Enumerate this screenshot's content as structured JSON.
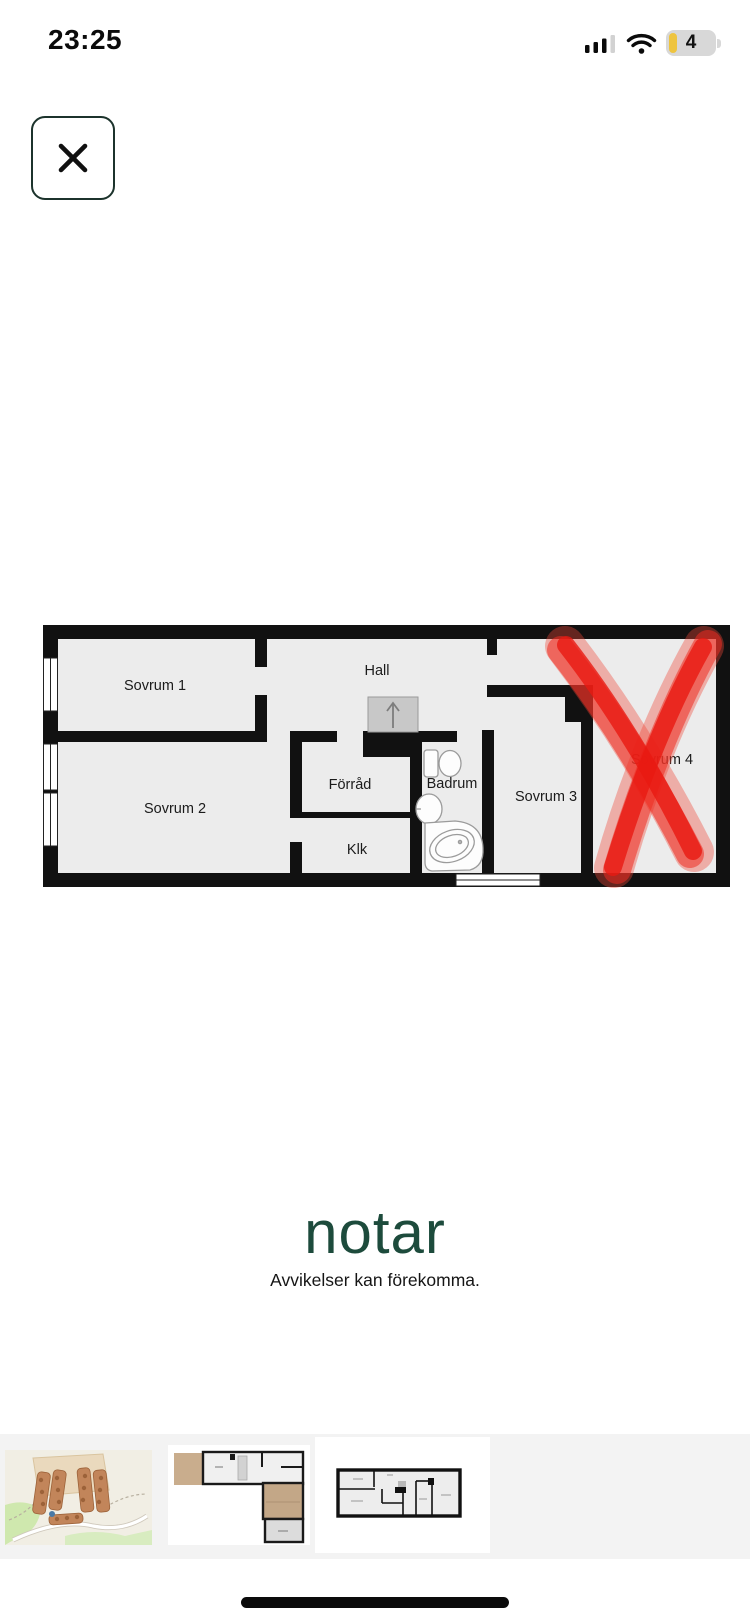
{
  "status_bar": {
    "time": "23:25",
    "battery_level": "4"
  },
  "floorplan": {
    "rooms": [
      {
        "label": "Sovrum 1"
      },
      {
        "label": "Sovrum 2"
      },
      {
        "label": "Hall"
      },
      {
        "label": "Förråd"
      },
      {
        "label": "Klk"
      },
      {
        "label": "Badrum"
      },
      {
        "label": "Sovrum 3"
      },
      {
        "label": "Sovrum 4"
      }
    ]
  },
  "annotation": {
    "marker_color": "#ee2c1f",
    "shape": "X over Sovrum 4"
  },
  "branding": {
    "logo": "notar",
    "tagline": "Avvikelser kan förekomma.",
    "logo_color": "#1d4b3c"
  },
  "colors": {
    "wall": "#111111",
    "room_fill": "#ececec",
    "stairs_fill": "#c8c8c8",
    "thumbnail_strip_bg": "#f3f3f3"
  }
}
